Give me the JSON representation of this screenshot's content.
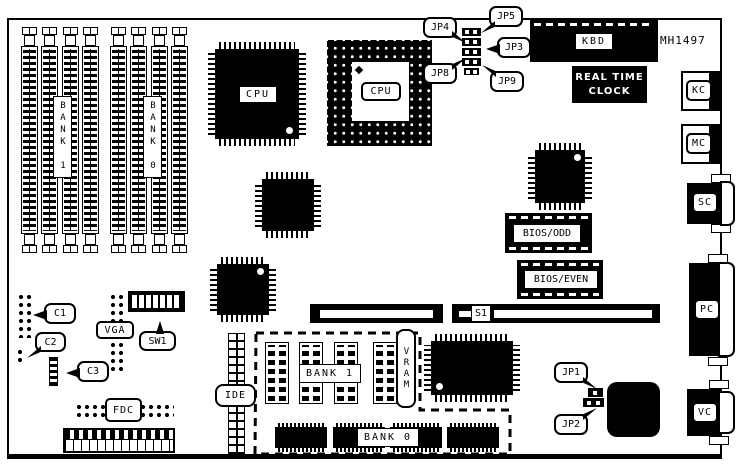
{
  "board": {
    "part_number": "MH1497"
  },
  "memory": {
    "simm_bank1": "BANK 1",
    "simm_bank0": "BANK 0",
    "dram_bank1": "BANK 1",
    "dram_bank0": "BANK 0",
    "vram": "VRAM"
  },
  "cpu": {
    "qfp": "CPU",
    "pga": "CPU"
  },
  "chips": {
    "kbd": "KBD",
    "rtc_lines": [
      "REAL TIME",
      "CLOCK"
    ],
    "bios_odd": "BIOS/ODD",
    "bios_even": "BIOS/EVEN"
  },
  "jumpers": {
    "jp1": "JP1",
    "jp2": "JP2",
    "jp3": "JP3",
    "jp4": "JP4",
    "jp5": "JP5",
    "jp8": "JP8",
    "jp9": "JP9"
  },
  "headers": {
    "c1": "C1",
    "c2": "C2",
    "c3": "C3",
    "vga": "VGA",
    "sw1": "SW1",
    "fdc": "FDC",
    "ide": "IDE",
    "s1": "S1"
  },
  "rear_connectors": {
    "kc": "KC",
    "mc": "MC",
    "sc": "SC",
    "pc": "PC",
    "vc": "VC"
  }
}
